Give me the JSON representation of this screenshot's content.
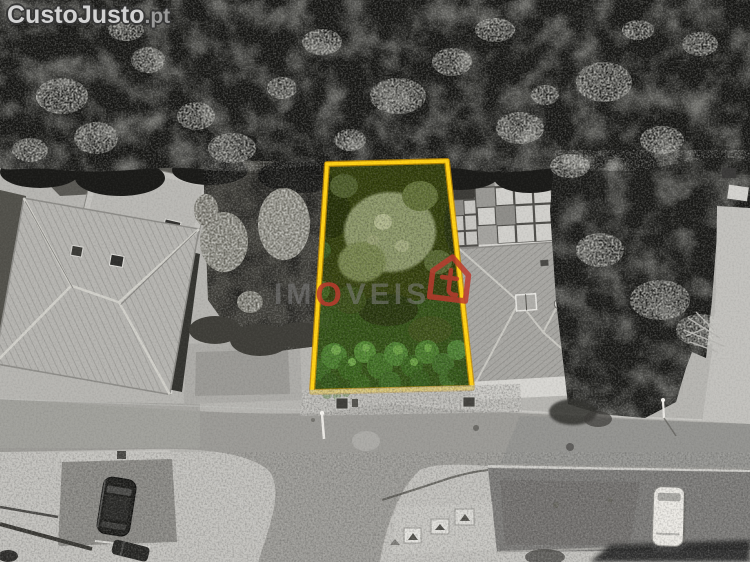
{
  "watermarks": {
    "site_logo": {
      "brand": "CustoJusto",
      "suffix": ".pt"
    },
    "agency": {
      "text_prefix": "IM",
      "text_accent": "O",
      "text_suffix": "VEIS"
    }
  },
  "icons": {
    "agency_house": "house-icon"
  },
  "palette": {
    "plot_outline": "#ffd215",
    "plot_outline_shadow": "#c98f00",
    "agency_red": "#bb3a2e",
    "agency_red_soft": "rgba(187,58,46,0.85)",
    "logo_fill": "#d2d2d2",
    "forest_dark": "#161614",
    "plot_green_dark": "#3c4f15",
    "plot_green_bright": "#4d8030",
    "road_gray": "#9c9b97",
    "gravel_light": "#c3c2be"
  },
  "highlight": {
    "shape": "quadrilateral",
    "corners": "327,164 447,161 472,388 312,392"
  }
}
